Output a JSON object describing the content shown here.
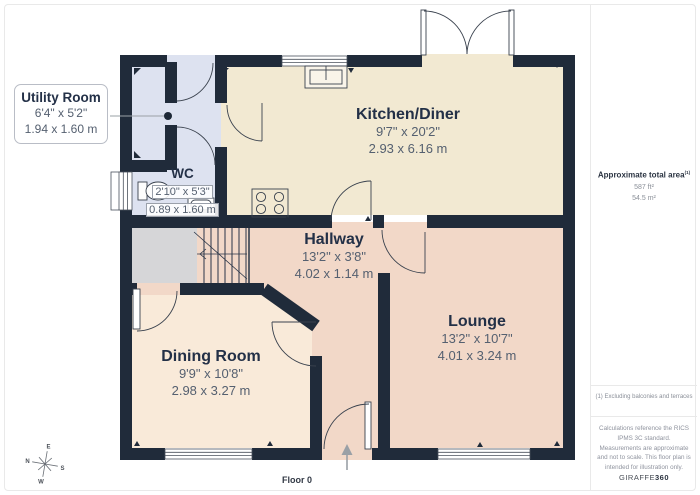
{
  "plan": {
    "floor_label": "Floor 0",
    "rooms": {
      "utility": {
        "name": "Utility Room",
        "imperial": "6'4\" x 5'2\"",
        "metric": "1.94 x 1.60 m"
      },
      "wc": {
        "name": "WC",
        "imperial": "2'10\" x 5'3\"",
        "metric": "0.89 x 1.60 m"
      },
      "kitchen": {
        "name": "Kitchen/Diner",
        "imperial": "9'7\" x 20'2\"",
        "metric": "2.93 x 6.16 m"
      },
      "hallway": {
        "name": "Hallway",
        "imperial": "13'2\" x 3'8\"",
        "metric": "4.02 x 1.14 m"
      },
      "lounge": {
        "name": "Lounge",
        "imperial": "13'2\" x 10'7\"",
        "metric": "4.01 x 3.24 m"
      },
      "dining": {
        "name": "Dining Room",
        "imperial": "9'9\" x 10'8\"",
        "metric": "2.98 x 3.27 m"
      }
    },
    "compass": {
      "n": "N",
      "e": "E",
      "s": "S",
      "w": "W"
    }
  },
  "sidebar": {
    "area_title": "Approximate total area",
    "area_superscript": "(1)",
    "area_imperial": "587 ft²",
    "area_metric": "54.5 m²",
    "footnote": "(1) Excluding balconies and terraces",
    "disclaimer": "Calculations reference the RICS IPMS 3C standard. Measurements are approximate and not to scale. This floor plan is intended for illustration only.",
    "brand": "GIRAFFE",
    "brand_suffix": "360"
  },
  "colors": {
    "wall": "#202b3a",
    "kitchen_fill": "#f2e9d2",
    "utility_fill": "#dde2f0",
    "hallway_fill": "#f2d8c8",
    "dining_fill": "#f9ead9",
    "understairs_fill": "#d6d6d8"
  }
}
